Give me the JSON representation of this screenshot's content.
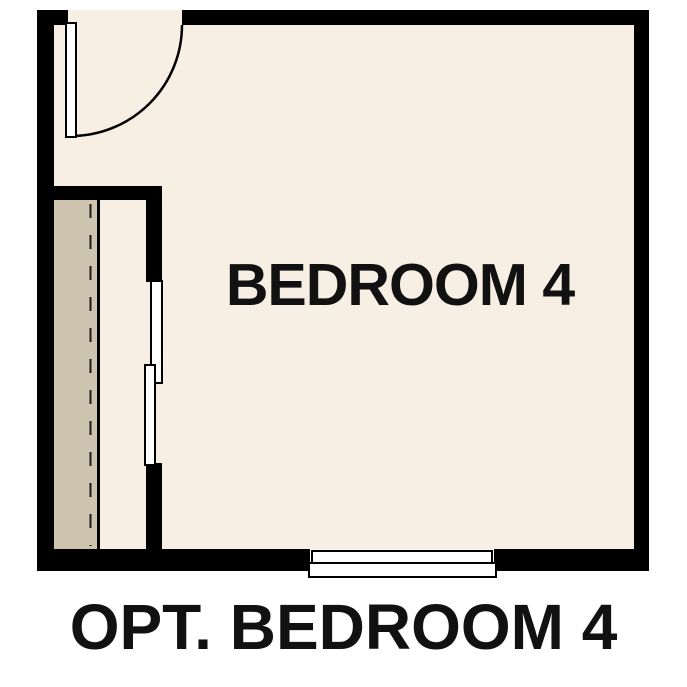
{
  "plan": {
    "room_label": "BEDROOM 4",
    "caption": "OPT. BEDROOM 4"
  },
  "colors": {
    "wall": "#000000",
    "floor": "#f7efe4",
    "closet_floor": "#cdc3ae",
    "door_fill": "#ffffff",
    "window_fill": "#ffffff",
    "label_text": "#111111",
    "page_bg": "#ffffff"
  }
}
